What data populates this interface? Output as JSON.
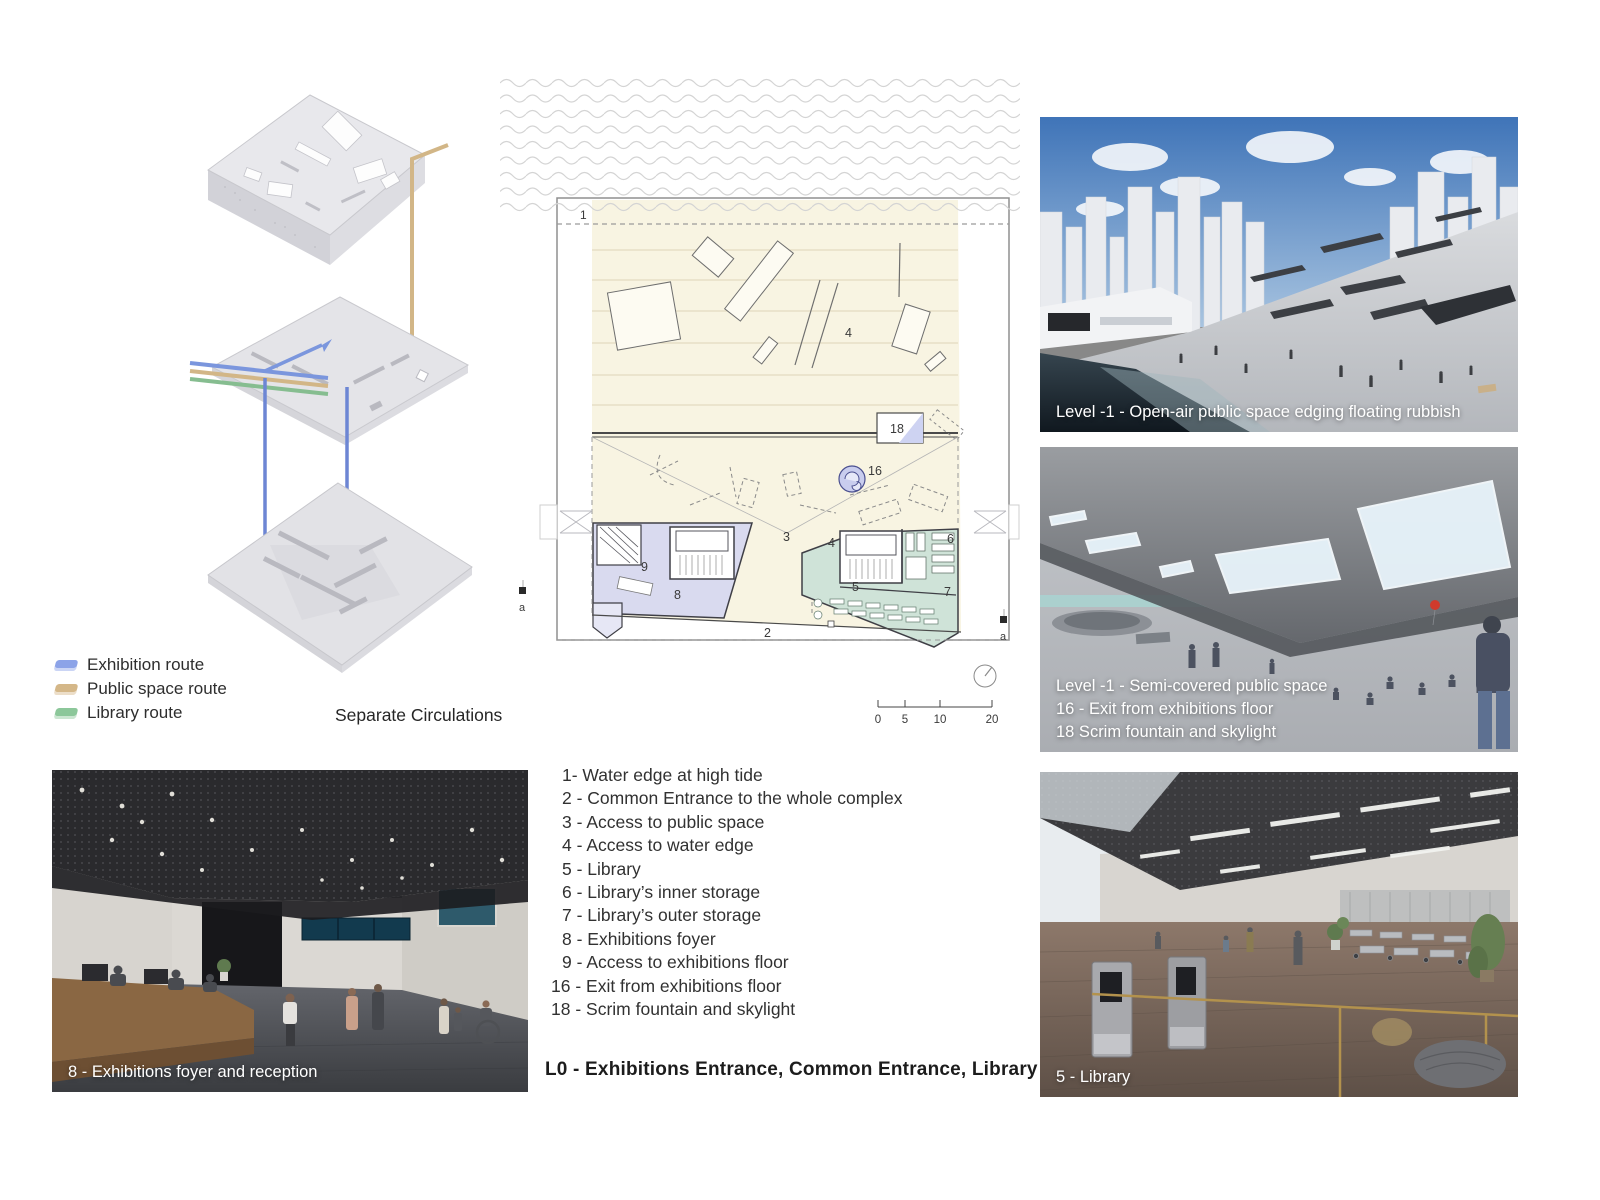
{
  "legend": {
    "items": [
      {
        "label": "Exhibition route",
        "color": "#8ca3e8"
      },
      {
        "label": "Public space route",
        "color": "#d4b788"
      },
      {
        "label": "Library route",
        "color": "#8cc79a"
      }
    ],
    "title": "Separate Circulations"
  },
  "plan": {
    "labels": {
      "n1": "1",
      "n2": "2",
      "n3": "3",
      "n4": "4",
      "n5": "5",
      "n6": "6",
      "n7": "7",
      "n8": "8",
      "n9": "9",
      "n16": "16",
      "n18": "18",
      "a": "a"
    },
    "scale_ticks": [
      "0",
      "5",
      "10",
      "20"
    ],
    "colors": {
      "plaza_cream": "#f8f4e2",
      "exhibition_room": "#d9daef",
      "library_room": "#cfe3d8"
    }
  },
  "key_list": {
    "items": [
      "1- Water edge at high tide",
      "2 - Common Entrance to the whole complex",
      "3 - Access to public space",
      "4 - Access to water edge",
      "5 - Library",
      "6 - Library’s inner storage",
      "7 - Library’s outer storage",
      "8 - Exhibitions foyer",
      "9 - Access to exhibitions floor",
      "16 - Exit from exhibitions floor",
      "18 - Scrim fountain and skylight"
    ]
  },
  "renders": {
    "open_air": {
      "caption": "Level -1 - Open-air public space edging floating rubbish"
    },
    "semi_covered": {
      "lines": [
        "Level -1 - Semi-covered public space",
        "16 - Exit from exhibitions floor",
        "18 Scrim fountain and skylight"
      ]
    },
    "library": {
      "caption": "5 - Library"
    },
    "foyer": {
      "caption": "8 - Exhibitions foyer and reception"
    }
  },
  "board": {
    "title": "L0 - Exhibitions Entrance, Common Entrance, Library"
  }
}
